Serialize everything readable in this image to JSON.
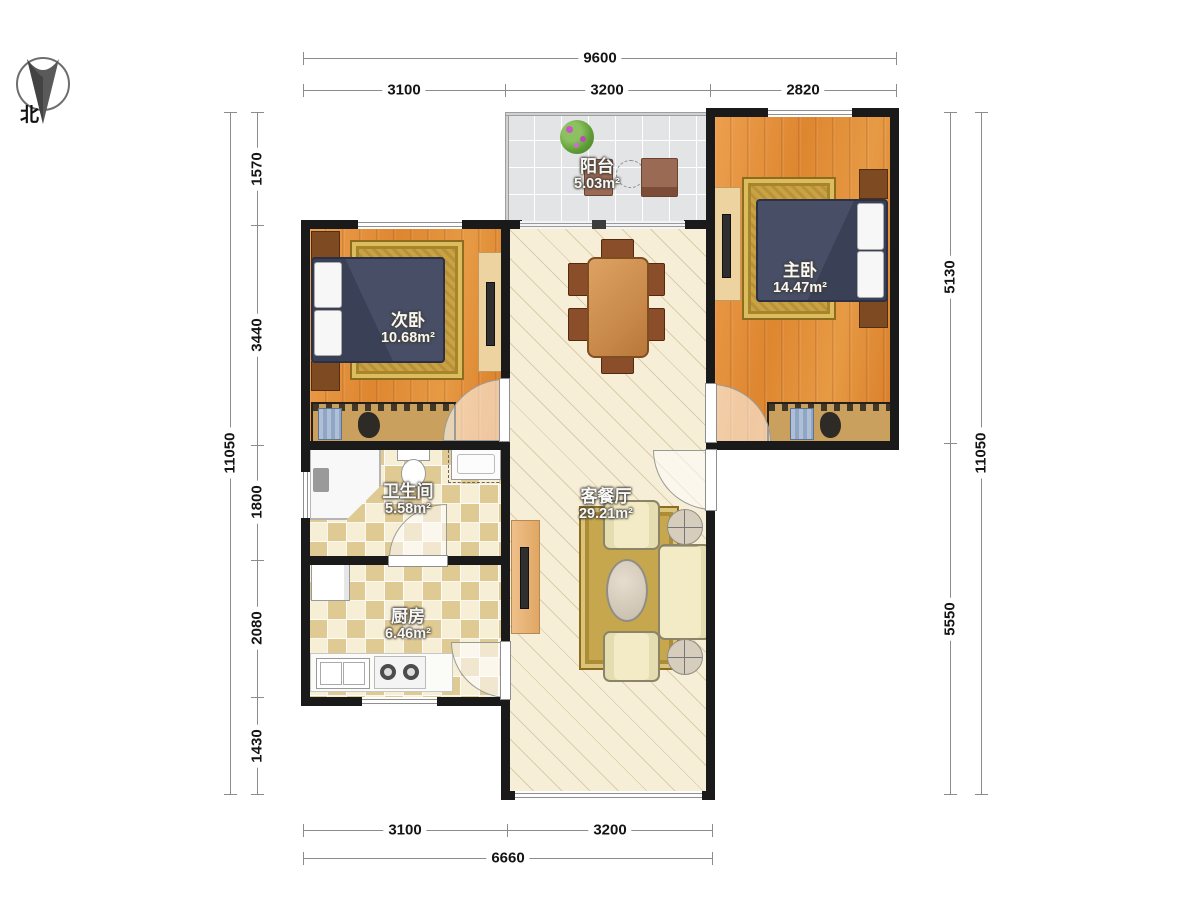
{
  "compass": {
    "north_label": "北"
  },
  "dims": {
    "top_total": "9600",
    "top_segments": [
      "3100",
      "3200",
      "2820"
    ],
    "bottom_segments": [
      "3100",
      "3200"
    ],
    "bottom_total": "6660",
    "left_total": "11050",
    "left_segments": [
      "1570",
      "3440",
      "1800",
      "2080",
      "1430"
    ],
    "right_segments": [
      "5130",
      "5550"
    ],
    "right_total": "11050"
  },
  "rooms": [
    {
      "id": "balcony",
      "name": "阳台",
      "area": "5.03m²"
    },
    {
      "id": "master-bedroom",
      "name": "主卧",
      "area": "14.47m²"
    },
    {
      "id": "second-bedroom",
      "name": "次卧",
      "area": "10.68m²"
    },
    {
      "id": "bathroom",
      "name": "卫生间",
      "area": "5.58m²"
    },
    {
      "id": "kitchen",
      "name": "厨房",
      "area": "6.46m²"
    },
    {
      "id": "living-dining",
      "name": "客餐厅",
      "area": "29.21m²"
    }
  ],
  "colors": {
    "wall": "#1a1a1a",
    "wood_floor": "#e08b36",
    "tile_floor": "#f1e5c2",
    "living_floor": "#f6eed7",
    "balcony_floor": "#e3e4e6",
    "rug_gold": "#c8a342",
    "bed_navy": "#3f4659",
    "dimension_text": "#141414"
  }
}
